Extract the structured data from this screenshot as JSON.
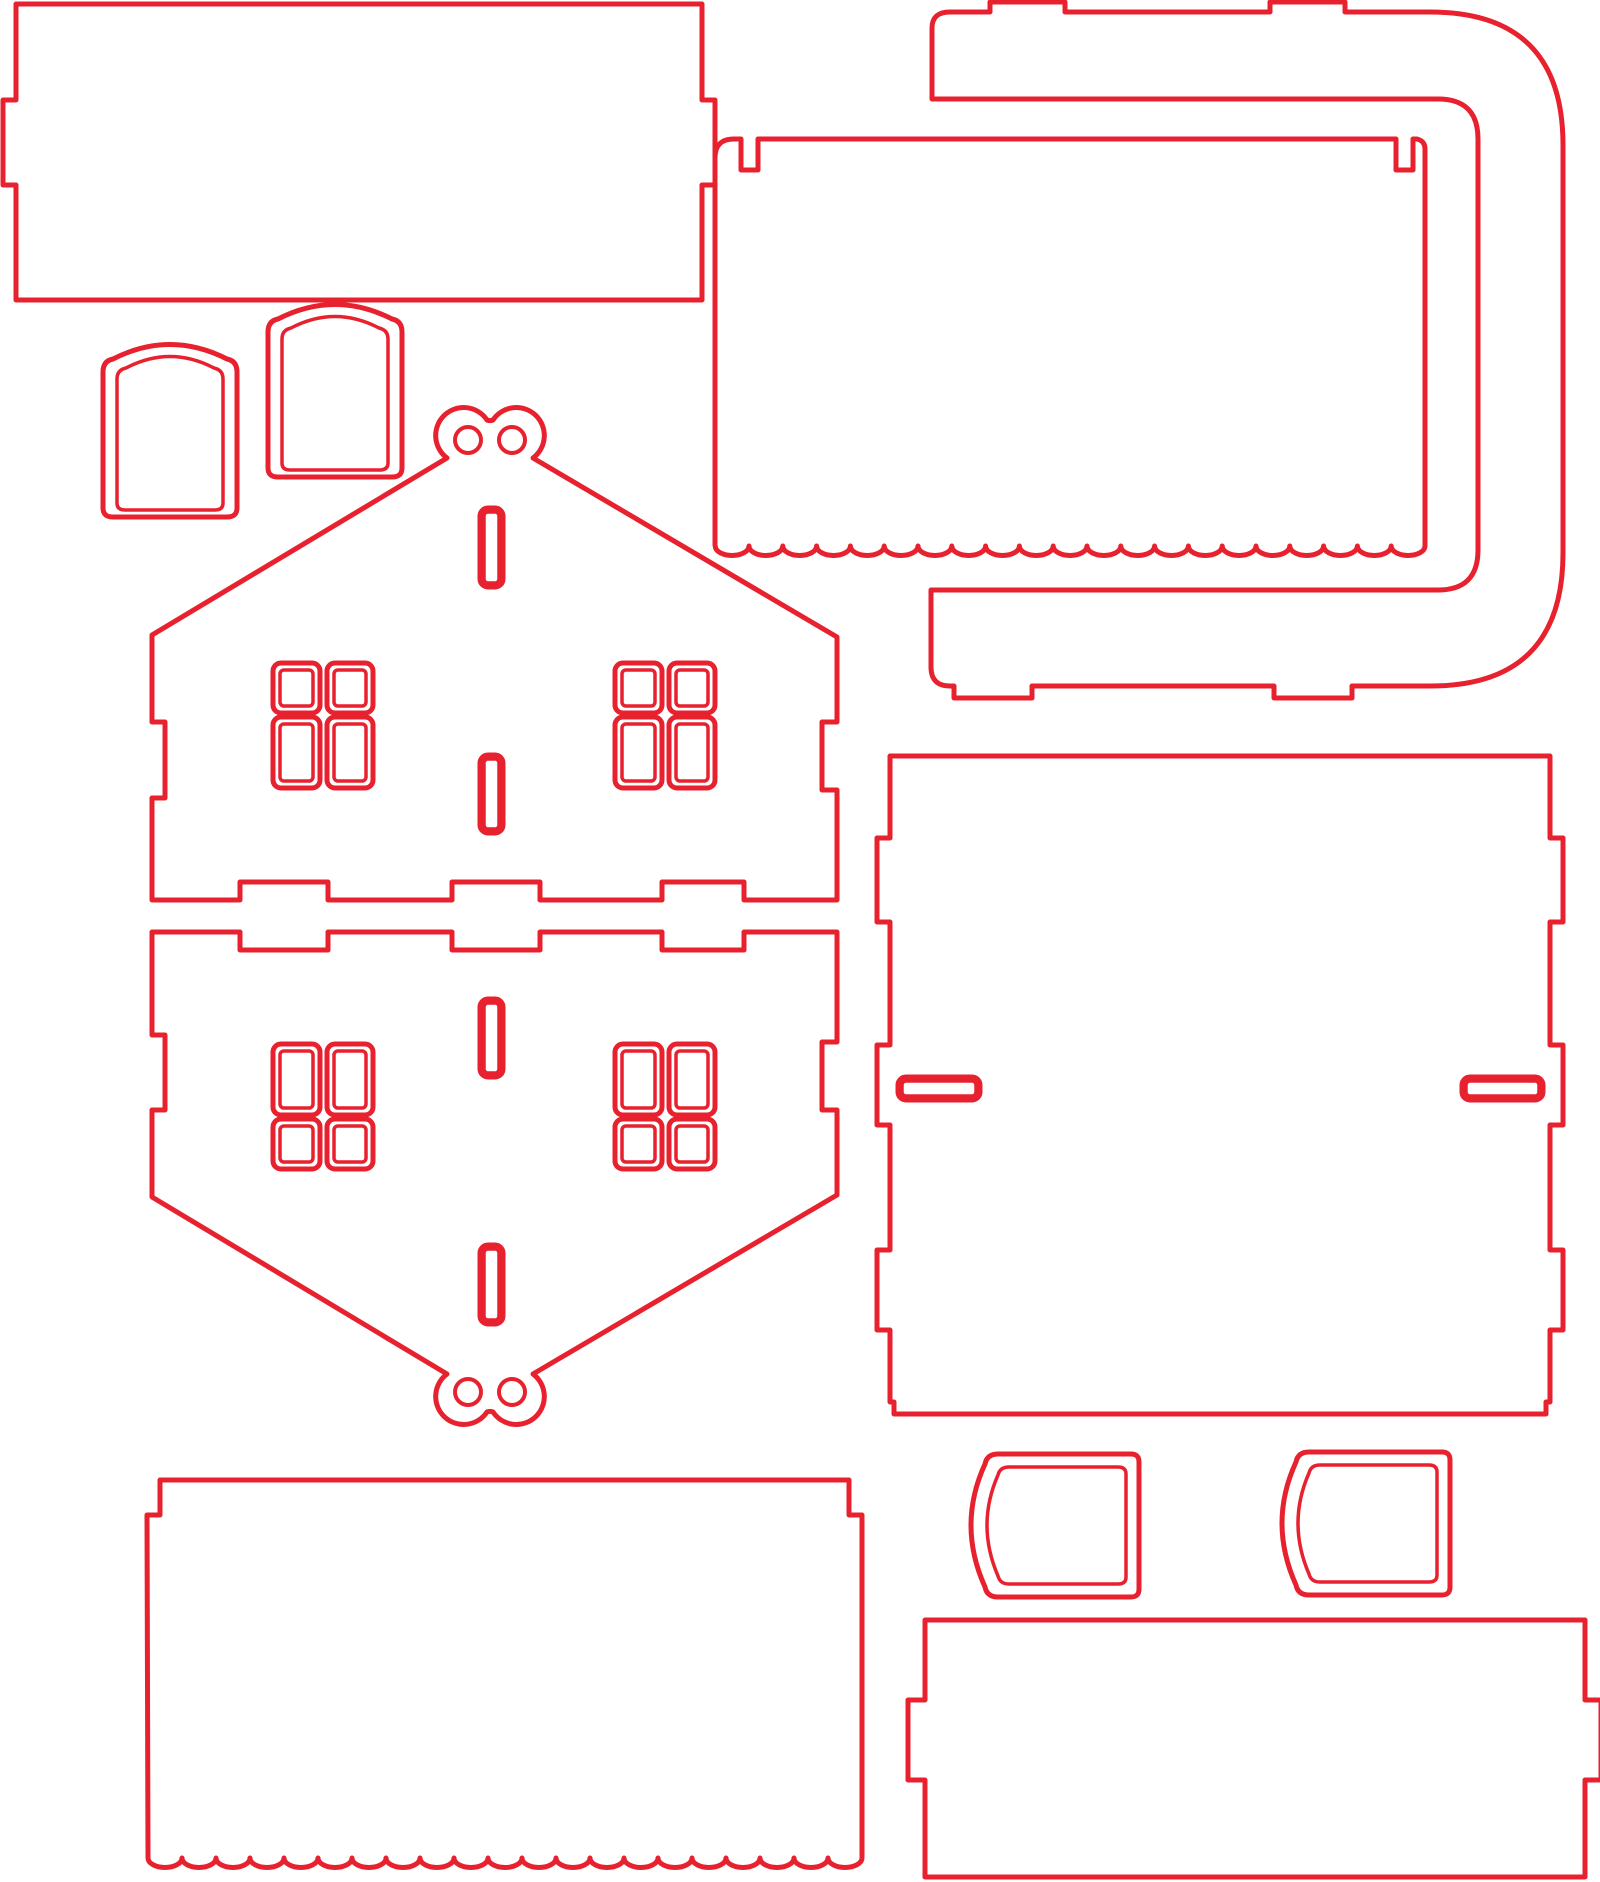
{
  "meta": {
    "document_kind": "laser-cut-template",
    "canvas": {
      "width": 1600,
      "height": 1882
    },
    "colors": {
      "cut_line": "#e8212f",
      "background": "#ffffff"
    },
    "stroke_widths": {
      "outline": 5,
      "detail": 3.5,
      "hole": 4
    }
  },
  "pieces": [
    {
      "name": "back-wall-panel",
      "kind": "outline",
      "d": "M 16,4 L 702,4 L 702,100 L 715,100 L 715,185 L 702,185 L 702,300 L 16,300 L 16,185 L 3,185 L 3,100 L 16,100 Z"
    },
    {
      "name": "curved-roof-bracket",
      "kind": "outline",
      "d": "M 932,28 Q 932,12 950,12 L 990,12 L 990,2 L 1065,2 L 1065,12 L 1270,12 L 1270,2 L 1345,2 L 1345,12 L 1430,12 Q 1563,12 1563,145 L 1563,553 Q 1563,686 1430,686 L 1352,686 L 1352,698 L 1274,698 L 1274,686 L 1032,686 L 1032,698 L 954,698 L 954,686 L 950,686 Q 931,686 931,667 L 931,590 L 1438,590 Q 1478,590 1478,550 L 1478,139 Q 1478,99 1438,99 L 932,99 Z"
    },
    {
      "name": "roof-panel-top",
      "kind": "outline",
      "d": "M 715,545 L 715,158 Q 715,139 734,139 L 741,139 L 741,170 L 758,170 L 758,139 L 1396,139 L 1396,170 L 1413,170 L 1413,139 L 1417,139 Q 1425,141 1425,149 L 1425,546 a 16.9,9.5 0 0 1 -33.8,0 a 16.9,9.5 0 0 1 -33.8,0 a 16.9,9.5 0 0 1 -33.8,0 a 16.9,9.5 0 0 1 -33.8,0 a 16.9,9.5 0 0 1 -33.8,0 a 16.9,9.5 0 0 1 -33.8,0 a 16.9,9.5 0 0 1 -33.8,0 a 16.9,9.5 0 0 1 -33.8,0 a 16.9,9.5 0 0 1 -33.8,0 a 16.9,9.5 0 0 1 -33.8,0 a 16.9,9.5 0 0 1 -33.8,0 a 16.9,9.5 0 0 1 -33.8,0 a 16.9,9.5 0 0 1 -33.8,0 a 16.9,9.5 0 0 1 -33.8,0 a 16.9,9.5 0 0 1 -33.8,0 a 16.9,9.5 0 0 1 -33.8,0 a 16.9,9.5 0 0 1 -33.8,0 a 16.9,9.5 0 0 1 -33.8,0 a 16.9,9.5 0 0 1 -33.8,0 a 16.9,9.5 0 0 1 -33.8,0 a 16.9,9.5 0 0 1 -33.8,0 Z"
    },
    {
      "name": "door-blank-small",
      "kind": "outline",
      "d": "M 103,508 L 103,372 Q 103,361 113,359 Q 170,330 227,359 Q 237,361 237,372 L 237,508 Q 237,517 227,517 L 113,517 Q 103,517 103,508 Z"
    },
    {
      "name": "door-blank-small-inner-line",
      "kind": "detail",
      "d": "M 117,503 L 117,379 Q 117,370 126,368 Q 170,345 214,368 Q 223,370 223,379 L 223,503 Q 223,510 215,510 L 125,510 Q 117,510 117,503 Z"
    },
    {
      "name": "door-blank-large",
      "kind": "outline",
      "d": "M 268,468 L 268,332 Q 268,321 278,319 Q 335,290 392,319 Q 402,321 402,332 L 402,468 Q 402,477 392,477 L 278,477 Q 268,477 268,468 Z"
    },
    {
      "name": "door-blank-large-inner-line",
      "kind": "detail",
      "d": "M 282,463 L 282,339 Q 282,330 291,328 Q 335,305 379,328 Q 388,330 388,339 L 388,463 Q 388,470 380,470 L 290,470 Q 282,470 282,463 Z"
    },
    {
      "name": "house-front-wall",
      "kind": "outline",
      "d": "M 152,635 L 447,458 A 28,28 0 1 1 487,420 A 8,8 0 0 0 493,420 A 28,28 0 1 1 533,458 L 837,637 L 837,722 L 822,722 L 822,790 L 837,790 L 837,900 L 744,900 L 744,882 L 662,882 L 662,900 L 540,900 L 540,882 L 452,882 L 452,900 L 328,900 L 328,882 L 240,882 L 240,900 L 152,900 L 152,798 L 165,798 L 165,722 L 152,722 Z"
    },
    {
      "name": "house-back-wall",
      "kind": "outline",
      "d": "M 152,1197 L 447,1374 A 28,28 0 1 0 487,1412 A 8,8 0 0 1 493,1412 A 28,28 0 1 0 533,1374 L 837,1195 L 837,1110 L 822,1110 L 822,1042 L 837,1042 L 837,932 L 744,932 L 744,950 L 662,950 L 662,932 L 540,932 L 540,950 L 452,950 L 452,932 L 328,932 L 328,950 L 240,950 L 240,932 L 152,932 L 152,1035 L 165,1035 L 165,1110 L 152,1110 Z"
    },
    {
      "name": "base-panel",
      "kind": "outline",
      "d": "M 890,756 L 1550,756 L 1550,838 L 1563,838 L 1563,922 L 1550,922 L 1550,1045 L 1563,1045 L 1563,1125 L 1550,1125 L 1550,1250 L 1563,1250 L 1563,1330 L 1550,1330 L 1550,1402 L 1546,1402 L 1546,1414 L 894,1414 L 894,1402 L 890,1402 L 890,1330 L 877,1330 L 877,1250 L 890,1250 L 890,1125 L 877,1125 L 877,1045 L 890,1045 L 890,922 L 877,922 L 877,838 L 890,838 Z"
    },
    {
      "name": "roof-panel-bottom",
      "kind": "outline",
      "d": "M 160,1480 L 849,1480 L 849,1515 L 862,1515 L 862,1858 a 17,9.5 0 0 1 -34,0 a 17,9.5 0 0 1 -34,0 a 17,9.5 0 0 1 -34,0 a 17,9.5 0 0 1 -34,0 a 17,9.5 0 0 1 -34,0 a 17,9.5 0 0 1 -34,0 a 17,9.5 0 0 1 -34,0 a 17,9.5 0 0 1 -34,0 a 17,9.5 0 0 1 -34,0 a 17,9.5 0 0 1 -34,0 a 17,9.5 0 0 1 -34,0 a 17,9.5 0 0 1 -34,0 a 17,9.5 0 0 1 -34,0 a 17,9.5 0 0 1 -34,0 a 17,9.5 0 0 1 -34,0 a 17,9.5 0 0 1 -34,0 a 17,9.5 0 0 1 -34,0 a 17,9.5 0 0 1 -34,0 a 17,9.5 0 0 1 -34,0 a 17,9.5 0 0 1 -34,0 a 17,9.5 0 0 1 -34,0 L 147,1515 L 160,1515 Z"
    },
    {
      "name": "window-awning-left",
      "kind": "outline",
      "d": "M 1131,1454 Q 1139,1454 1139,1462 L 1139,1589 Q 1139,1597 1131,1597 L 998,1597 Q 987,1597 985,1587 Q 957,1525 985,1464 Q 987,1454 998,1454 Z"
    },
    {
      "name": "window-awning-left-inner-line",
      "kind": "detail",
      "d": "M 1118,1467 Q 1126,1467 1126,1474 L 1126,1577 Q 1126,1584 1118,1584 L 1009,1584 Q 1000,1584 998,1576 Q 976,1525 998,1475 Q 1000,1467 1009,1467 Z"
    },
    {
      "name": "window-awning-right",
      "kind": "outline",
      "d": "M 1442,1452 Q 1450,1452 1450,1460 L 1450,1587 Q 1450,1595 1442,1595 L 1309,1595 Q 1298,1595 1296,1585 Q 1268,1523 1296,1462 Q 1298,1452 1309,1452 Z"
    },
    {
      "name": "window-awning-right-inner-line",
      "kind": "detail",
      "d": "M 1429,1465 Q 1437,1465 1437,1472 L 1437,1575 Q 1437,1582 1429,1582 L 1320,1582 Q 1311,1582 1309,1574 Q 1287,1523 1309,1473 Q 1311,1465 1320,1465 Z"
    },
    {
      "name": "side-wall-panel",
      "kind": "outline",
      "d": "M 925,1620 L 1585,1620 L 1585,1700 L 1601,1700 L 1601,1780 L 1585,1780 L 1585,1877 L 925,1877 L 925,1780 L 908,1780 L 908,1700 L 925,1700 Z"
    }
  ],
  "cutouts": [
    {
      "name": "front-wall-window-pane",
      "type": "pane",
      "x": 273,
      "y": 663,
      "w": 47,
      "h": 50
    },
    {
      "name": "front-wall-window-pane",
      "type": "pane",
      "x": 327,
      "y": 663,
      "w": 46,
      "h": 50
    },
    {
      "name": "front-wall-window-pane",
      "type": "pane",
      "x": 273,
      "y": 717,
      "w": 47,
      "h": 71
    },
    {
      "name": "front-wall-window-pane",
      "type": "pane",
      "x": 327,
      "y": 717,
      "w": 46,
      "h": 71
    },
    {
      "name": "front-wall-window-pane",
      "type": "pane",
      "x": 615,
      "y": 663,
      "w": 47,
      "h": 50
    },
    {
      "name": "front-wall-window-pane",
      "type": "pane",
      "x": 669,
      "y": 663,
      "w": 46,
      "h": 50
    },
    {
      "name": "front-wall-window-pane",
      "type": "pane",
      "x": 615,
      "y": 717,
      "w": 47,
      "h": 71
    },
    {
      "name": "front-wall-window-pane",
      "type": "pane",
      "x": 669,
      "y": 717,
      "w": 46,
      "h": 71
    },
    {
      "name": "back-wall-window-pane",
      "type": "pane",
      "x": 273,
      "y": 1044,
      "w": 47,
      "h": 71
    },
    {
      "name": "back-wall-window-pane",
      "type": "pane",
      "x": 327,
      "y": 1044,
      "w": 46,
      "h": 71
    },
    {
      "name": "back-wall-window-pane",
      "type": "pane",
      "x": 273,
      "y": 1119,
      "w": 47,
      "h": 50
    },
    {
      "name": "back-wall-window-pane",
      "type": "pane",
      "x": 327,
      "y": 1119,
      "w": 46,
      "h": 50
    },
    {
      "name": "back-wall-window-pane",
      "type": "pane",
      "x": 615,
      "y": 1044,
      "w": 47,
      "h": 71
    },
    {
      "name": "back-wall-window-pane",
      "type": "pane",
      "x": 669,
      "y": 1044,
      "w": 46,
      "h": 71
    },
    {
      "name": "back-wall-window-pane",
      "type": "pane",
      "x": 615,
      "y": 1119,
      "w": 47,
      "h": 50
    },
    {
      "name": "back-wall-window-pane",
      "type": "pane",
      "x": 669,
      "y": 1119,
      "w": 46,
      "h": 50
    },
    {
      "name": "front-wall-center-slot",
      "type": "slot",
      "x": 480,
      "y": 508,
      "w": 23,
      "h": 79
    },
    {
      "name": "front-wall-center-slot",
      "type": "slot",
      "x": 480,
      "y": 755,
      "w": 23,
      "h": 78
    },
    {
      "name": "back-wall-center-slot",
      "type": "slot",
      "x": 480,
      "y": 999,
      "w": 23,
      "h": 78
    },
    {
      "name": "back-wall-center-slot",
      "type": "slot",
      "x": 480,
      "y": 1245,
      "w": 23,
      "h": 79
    },
    {
      "name": "base-panel-left-slot",
      "type": "slot",
      "x": 898,
      "y": 1077,
      "w": 82,
      "h": 23
    },
    {
      "name": "base-panel-right-slot",
      "type": "slot",
      "x": 1462,
      "y": 1077,
      "w": 81,
      "h": 23
    },
    {
      "name": "front-wall-hanging-hole",
      "type": "hole",
      "cx": 468,
      "cy": 440,
      "r": 13
    },
    {
      "name": "front-wall-hanging-hole",
      "type": "hole",
      "cx": 512,
      "cy": 440,
      "r": 13
    },
    {
      "name": "back-wall-hanging-hole",
      "type": "hole",
      "cx": 468,
      "cy": 1392,
      "r": 13
    },
    {
      "name": "back-wall-hanging-hole",
      "type": "hole",
      "cx": 512,
      "cy": 1392,
      "r": 13
    }
  ]
}
